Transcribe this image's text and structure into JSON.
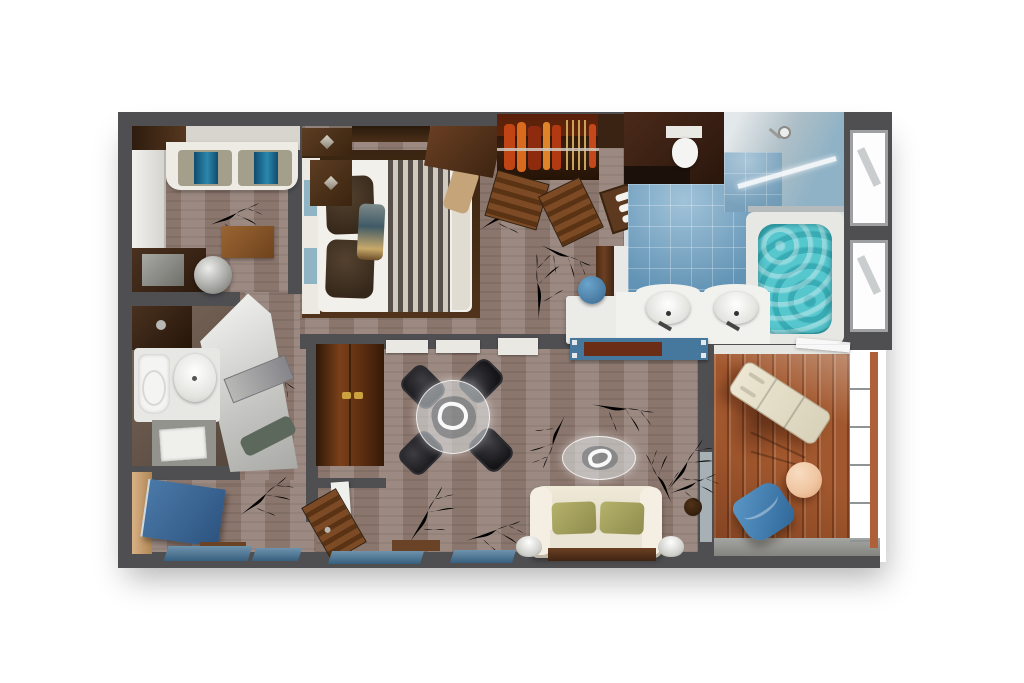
{
  "canvas": {
    "width": 1024,
    "height": 683
  },
  "palette": {
    "background": "#ffffff",
    "wall": "#4f4f52",
    "carpet": "#8b766d",
    "carpetLight": "#b5a498",
    "gold": "#aa7d33",
    "woodDark": "#3f2917",
    "wood": "#6b4023",
    "woodLight": "#8a5a2e",
    "deck": "#a2582e",
    "deckDark": "#8a4722",
    "tile": "#6fa3c5",
    "water": "#57c7ce",
    "cream": "#e9e3d2",
    "green": "#a3a05c",
    "doorBlue": "#3c6898",
    "chairBlue": "#3e7cb4",
    "peach": "#f0c6a2",
    "fixtureWhite": "#f1f0ec",
    "silver": "#c9c9c6",
    "charcoal": "#202024"
  },
  "rooms": {
    "second_bedroom": {
      "name": "second-bedroom",
      "furniture": [
        "daybed-with-striped-cushions",
        "side-table",
        "round-stool",
        "storage-unit",
        "closet-front"
      ]
    },
    "guest_bathroom": {
      "name": "guest-bathroom",
      "furniture": [
        "toilet",
        "washbasin",
        "shower-tray",
        "wood-counter",
        "angled-mirror-panel"
      ]
    },
    "entry_hall": {
      "name": "entry-hall",
      "furniture": [
        "blue-entry-door"
      ]
    },
    "master_bedroom": {
      "name": "master-bedroom",
      "furniture": [
        "double-bed",
        "striped-bed-runner",
        "two-brown-pillows",
        "nightstand-chests",
        "angled-dresser",
        "walk-in-wardrobe",
        "hanging-clothes",
        "towel-shelf",
        "vanity-desk",
        "blue-stool"
      ]
    },
    "master_bathroom": {
      "name": "master-bathroom",
      "furniture": [
        "toilet-compartment",
        "double-sink-vanity",
        "walk-in-shower",
        "whirlpool-tub",
        "two-windows"
      ]
    },
    "living_dining_room": {
      "name": "living-dining-room",
      "furniture": [
        "glass-dining-table",
        "four-black-chairs",
        "tall-wood-cabinet",
        "wall-console-desk",
        "glass-coffee-table",
        "cream-sofa",
        "two-green-cushions",
        "two-table-lamps",
        "sofa-console",
        "dried-plant",
        "window-band"
      ]
    },
    "balcony": {
      "name": "balcony",
      "furniture": [
        "chaise-lounge",
        "round-side-table",
        "blue-armchair",
        "glass-railing"
      ]
    }
  }
}
